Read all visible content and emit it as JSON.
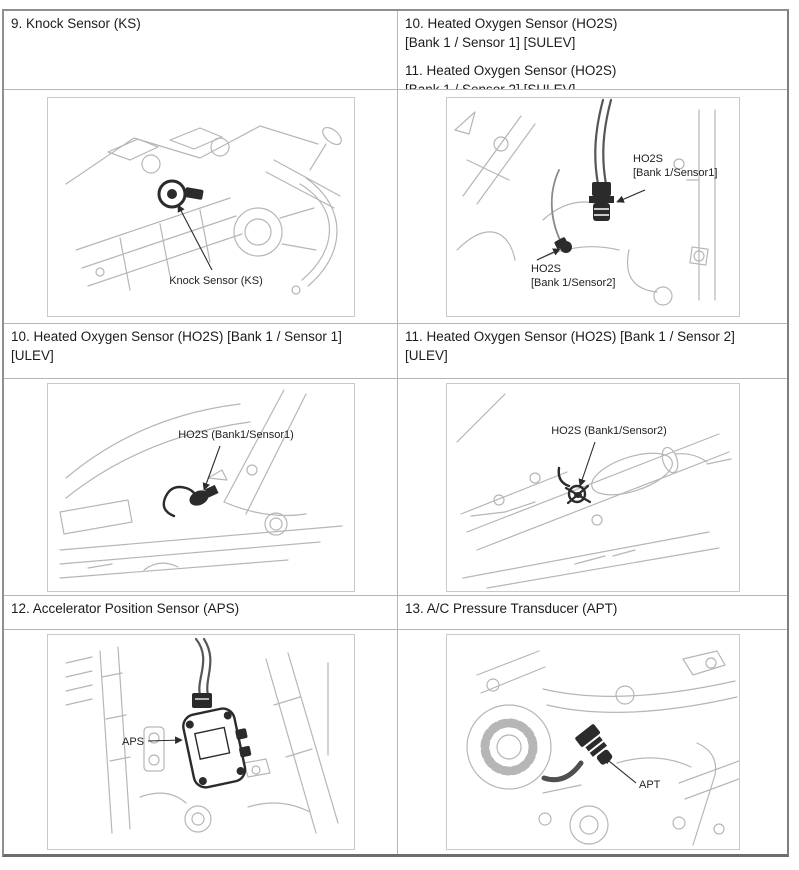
{
  "colors": {
    "table_outer_border": "#8f8f8f",
    "table_bottom_border": "#6d6d6d",
    "cell_border": "#b5b5b5",
    "figure_box_border": "#c9c9c9",
    "line_art": "#b6b6b6",
    "ink": "#2b2b2b",
    "text": "#1c1c1c",
    "background": "#ffffff"
  },
  "cells": {
    "knock_header": "9. Knock Sensor (KS)",
    "ho2s_sulev": {
      "item10_line1": "10. Heated Oxygen Sensor (HO2S)",
      "item10_line2": "[Bank 1 / Sensor 1] [SULEV]",
      "item11_line1": "11. Heated Oxygen Sensor (HO2S)",
      "item11_line2": "[Bank 1 / Sensor 2] [SULEV]"
    },
    "ho2s_ulev_s1": {
      "line1": "10. Heated Oxygen Sensor (HO2S) [Bank 1 / Sensor 1]",
      "line2": "[ULEV]"
    },
    "ho2s_ulev_s2": {
      "line1": "11. Heated Oxygen Sensor (HO2S) [Bank 1 / Sensor 2]",
      "line2": "[ULEV]"
    },
    "aps_header": "12. Accelerator Position Sensor (APS)",
    "apt_header": "13. A/C Pressure Transducer (APT)"
  },
  "figures": {
    "knock": {
      "label": "Knock Sensor (KS)"
    },
    "ho2s_sulev": {
      "s1_line1": "HO2S",
      "s1_line2": "[Bank 1/Sensor1]",
      "s2_line1": "HO2S",
      "s2_line2": "[Bank 1/Sensor2]"
    },
    "ho2s_ulev_s1": {
      "label": "HO2S (Bank1/Sensor1)"
    },
    "ho2s_ulev_s2": {
      "label": "HO2S (Bank1/Sensor2)"
    },
    "aps": {
      "label": "APS"
    },
    "apt": {
      "label": "APT"
    }
  }
}
